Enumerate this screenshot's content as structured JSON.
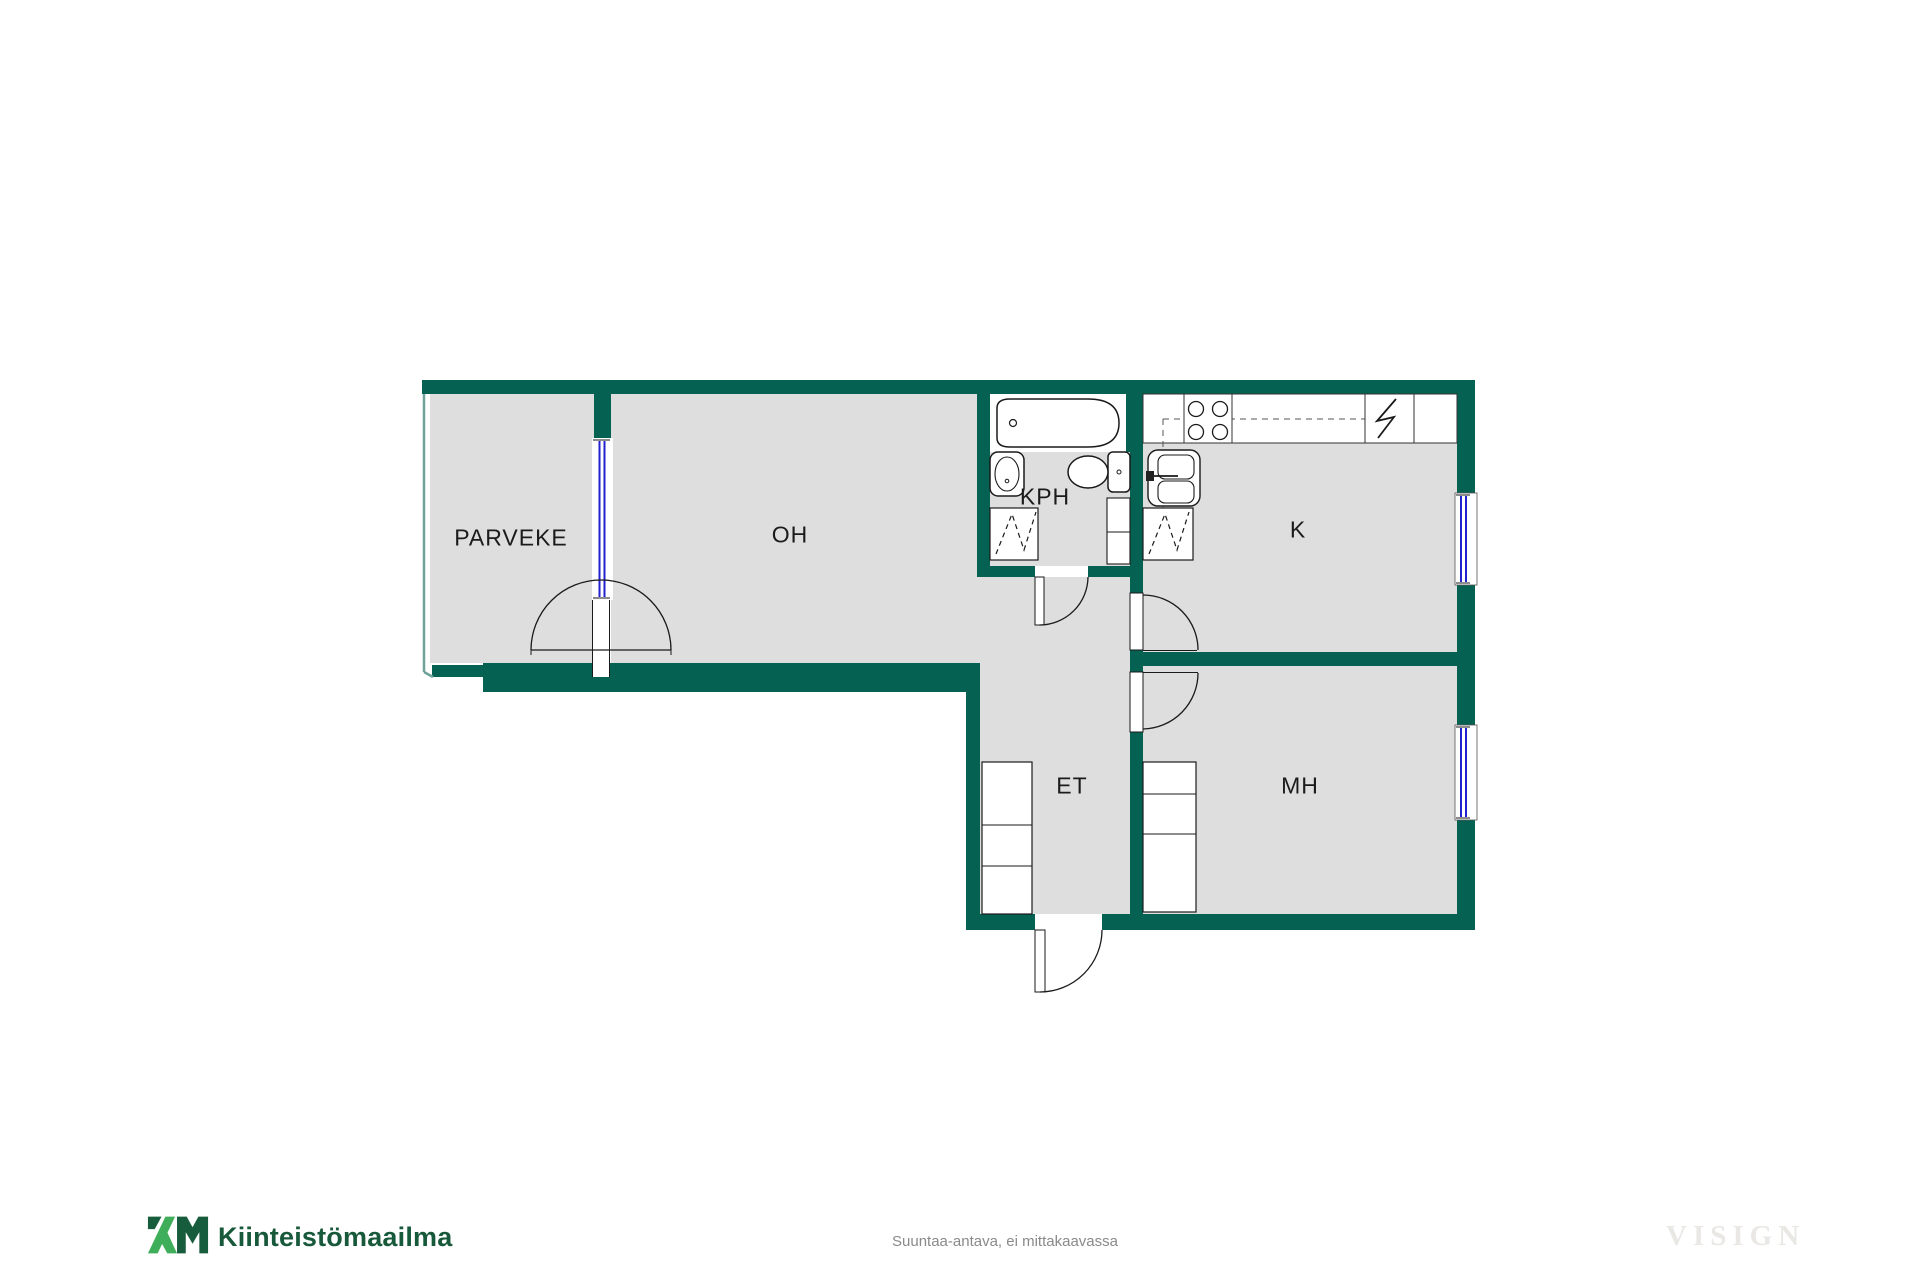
{
  "plan": {
    "rooms": [
      {
        "id": "parveke",
        "label": "PARVEKE"
      },
      {
        "id": "oh",
        "label": "OH"
      },
      {
        "id": "kph",
        "label": "KPH"
      },
      {
        "id": "k",
        "label": "K"
      },
      {
        "id": "et",
        "label": "ET"
      },
      {
        "id": "mh",
        "label": "MH"
      }
    ],
    "fixtures": [
      "bathtub",
      "washbasin",
      "toilet",
      "washing-machine",
      "bathroom-cabinet",
      "stove",
      "refrigerator",
      "kitchen-sink",
      "dishwasher",
      "hall-wardrobe",
      "bedroom-wardrobe",
      "balcony-door",
      "bathroom-door",
      "kitchen-door",
      "bedroom-door",
      "entrance-door",
      "balcony-window",
      "kitchen-window",
      "bedroom-window"
    ],
    "colors": {
      "wall": "#056252",
      "floor": "#dedede",
      "window_glass": "#2121d0",
      "line": "#1a1a1a",
      "balcony_rail": "#6fa29a"
    }
  },
  "footer": {
    "logo_mark": "KM",
    "brand": "Kiinteistömaailma",
    "disclaimer": "Suuntaa-antava, ei mittakaavassa",
    "watermark": "VISIGN"
  }
}
